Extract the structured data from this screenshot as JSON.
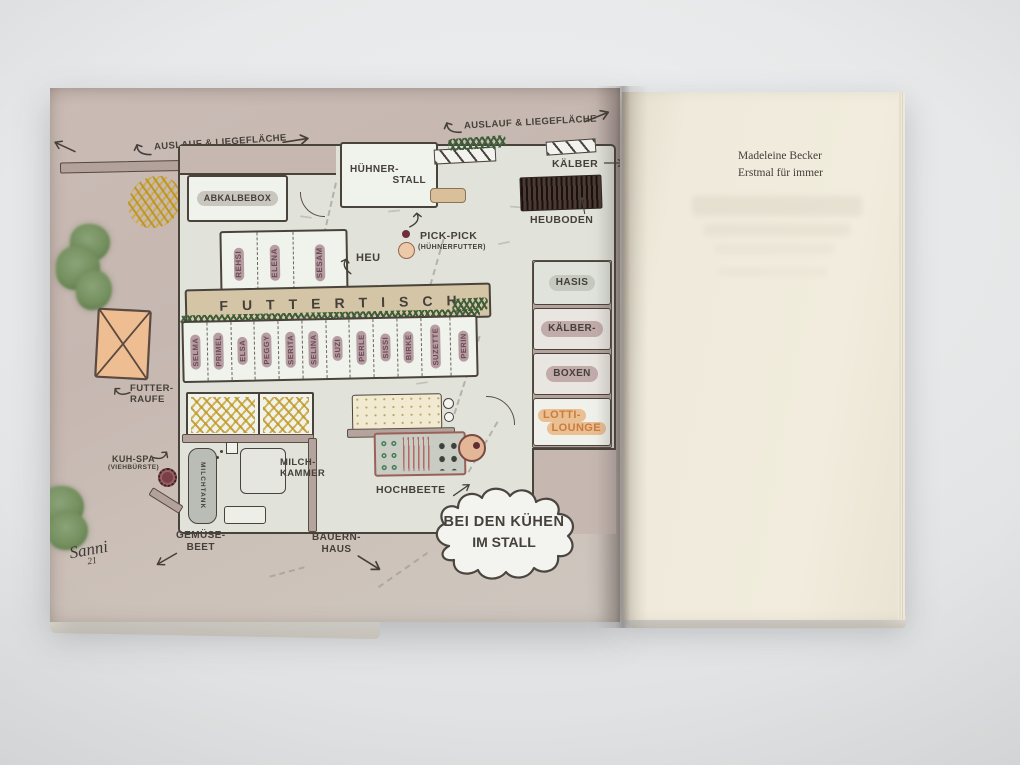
{
  "page_right": {
    "author": "Madeleine Becker",
    "title": "Erstmal für immer"
  },
  "map": {
    "auslauf_left": "AUSLAUF & LIEGEFLÄCHE",
    "auslauf_right": "AUSLAUF & LIEGEFLÄCHE",
    "abkalbebox": "ABKALBEBOX",
    "huehnerstall": {
      "line1": "HÜHNER-",
      "line2": "STALL"
    },
    "kaelber": "KÄLBER",
    "heuboden": "HEUBODEN",
    "pickpick": {
      "title": "PICK-PICK",
      "subtitle": "(HÜHNERFUTTER)"
    },
    "heu": "HEU",
    "futtertisch": "FUTTERTISCH",
    "cows_top": [
      "REHSI",
      "ELENA",
      "SESAM"
    ],
    "cows_bottom": [
      "SELMA",
      "PRIMEL",
      "ELSA",
      "PEGGY",
      "SERITA",
      "SELINA",
      "SUZI",
      "PERLE",
      "SISSI",
      "BIRKE",
      "SUZETTE",
      "PERIN"
    ],
    "rooms": {
      "hasis": "HASIS",
      "kaelber1": "KÄLBER-",
      "kaelber2": "BOXEN",
      "lotti1": "LOTTI-",
      "lotti2": "LOUNGE"
    },
    "futterraufe": {
      "line1": "FUTTER-",
      "line2": "RAUFE"
    },
    "kuhspa": {
      "line1": "KUH-SPA",
      "line2": "(VIEHBÜRSTE)"
    },
    "milchtank": "MILCHTANK",
    "milchkammer": {
      "line1": "MILCH-",
      "line2": "KAMMER"
    },
    "hochbeete": "HOCHBEETE",
    "cloud": {
      "line1": "BEI DEN KÜHEN",
      "line2": "IM STALL"
    },
    "gemuesebeet": {
      "line1": "GEMÜSE-",
      "line2": "BEET"
    },
    "bauernhaus": {
      "line1": "BAUERN-",
      "line2": "HAUS"
    },
    "signature": {
      "name": "Sanni",
      "year": "21"
    }
  },
  "colors": {
    "paper_mauve": "#c6b7b1",
    "barn_floor": "#e1e3da",
    "room_white": "#f0f2ec",
    "feed_table_tan": "#d3c5a6",
    "hedge_green": "#41603c",
    "straw_yellow": "#cfa63a",
    "hay_dark_brown": "#443430",
    "lotti_orange": "#c97c3d",
    "name_plate_mauve": "#b59da2",
    "ink": "#45403a",
    "right_page_cream": "#efeadb"
  }
}
